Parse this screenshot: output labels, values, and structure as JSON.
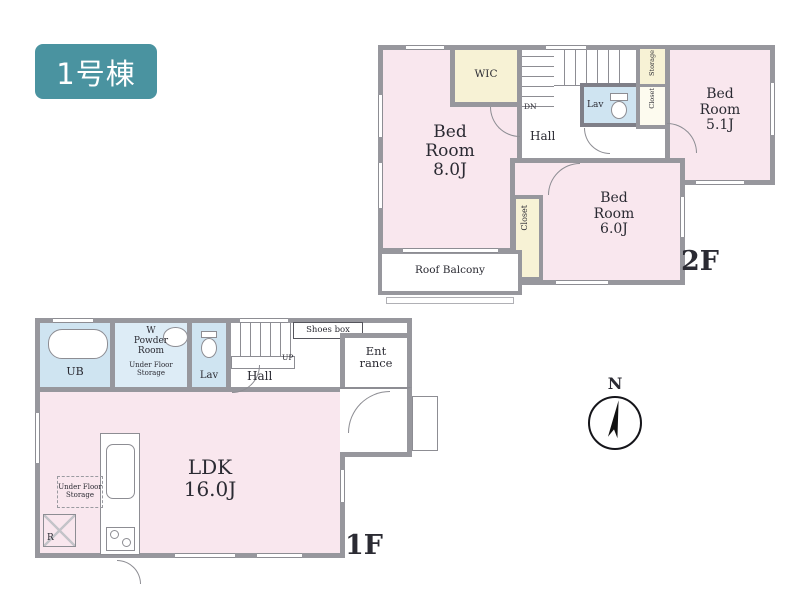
{
  "badge": {
    "label": "1号棟"
  },
  "compass": {
    "north_label": "N"
  },
  "colors": {
    "accent": "#4a93a0",
    "room_pink": "#f9e7ee",
    "room_yellow": "#f7f2d5",
    "room_blue": "#cfe4f1",
    "wall_gray": "#97979d"
  },
  "floor2": {
    "floor_label": "2F",
    "bedroom_8": {
      "label": "Bed\nRoom\n8.0J"
    },
    "wic": {
      "label": "WIC"
    },
    "stairs": {
      "label": "DN"
    },
    "hall": {
      "label": "Hall"
    },
    "lav": {
      "label": "Lav"
    },
    "storage": {
      "label": "Storage"
    },
    "closet_hall": {
      "label": "Closet"
    },
    "bedroom_5_1": {
      "label": "Bed\nRoom\n5.1J"
    },
    "bedroom_6": {
      "label": "Bed\nRoom\n6.0J"
    },
    "closet_6": {
      "label": "Closet"
    },
    "roof_balcony": {
      "label": "Roof Balcony"
    }
  },
  "floor1": {
    "floor_label": "1F",
    "ub": {
      "label": "UB"
    },
    "powder_room": {
      "label": "W\nPowder\nRoom"
    },
    "under_floor_storage_powder": {
      "label": "Under Floor\nStorage"
    },
    "lav": {
      "label": "Lav"
    },
    "stairs": {
      "label": "UP"
    },
    "hall": {
      "label": "Hall"
    },
    "shoes_box": {
      "label": "Shoes box"
    },
    "entrance": {
      "label": "Ent\nrance"
    },
    "ldk": {
      "label": "LDK\n16.0J"
    },
    "under_floor_storage_ldk": {
      "label": "Under Floor\nStorage"
    },
    "refrigerator": {
      "label": "R"
    }
  }
}
